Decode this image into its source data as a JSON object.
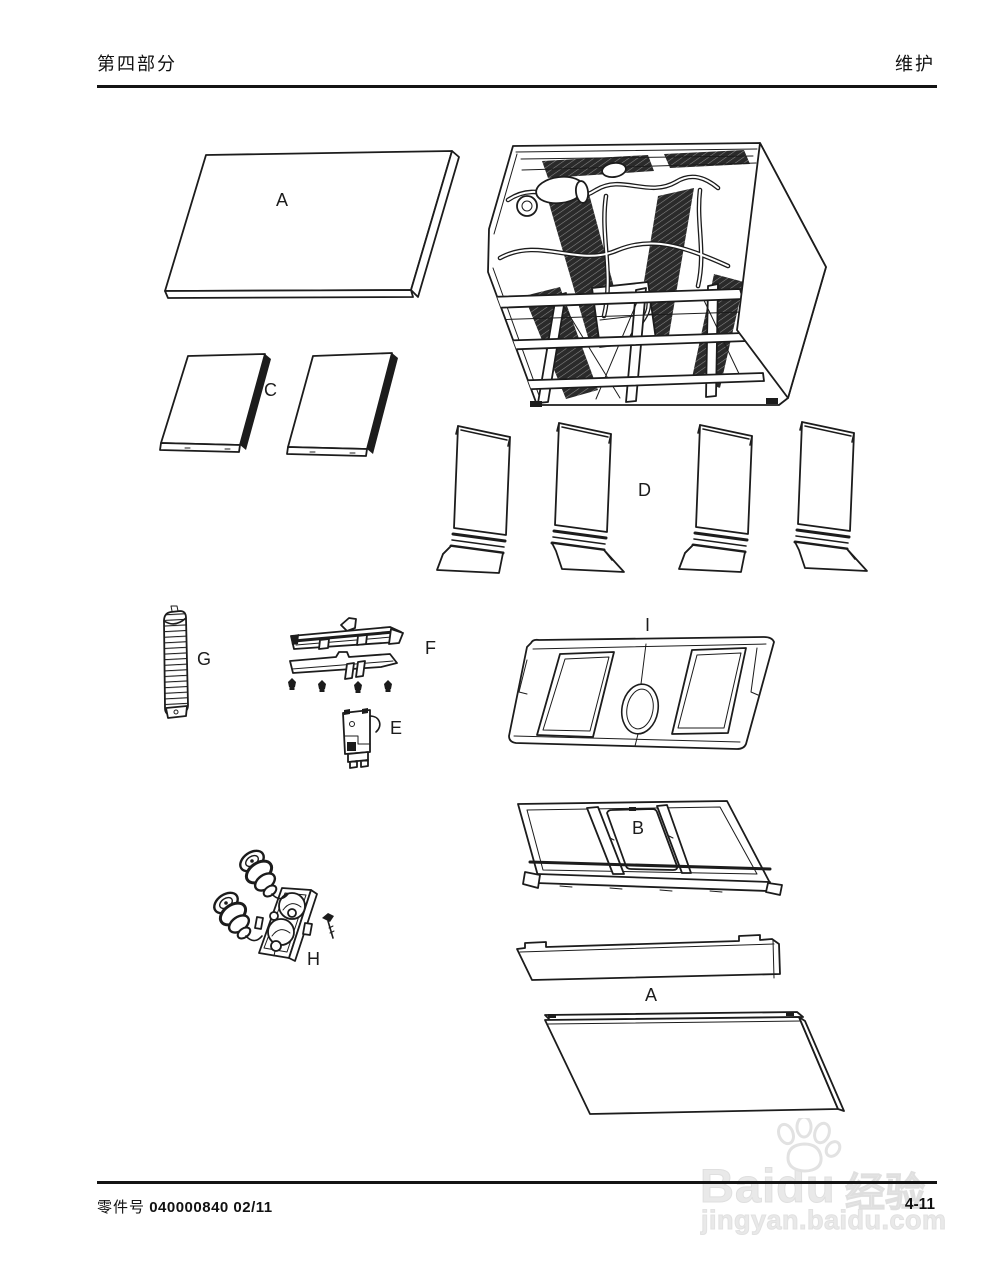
{
  "header": {
    "section": "第四部分",
    "title": "维护"
  },
  "diagram": {
    "labels": {
      "a_top": "A",
      "c": "C",
      "d": "D",
      "g": "G",
      "f": "F",
      "e": "E",
      "i": "I",
      "b": "B",
      "h": "H",
      "a_bottom": "A"
    }
  },
  "footer": {
    "part_no_label": "零件号",
    "part_no_value": "040000840 02/11",
    "page_number": "4-11"
  },
  "watermark": {
    "brand": "Baidu",
    "suffix": "经验",
    "url": "jingyan.baidu.com"
  },
  "colors": {
    "ink": "#1c1c1c",
    "watermark": "#e9e9e9"
  }
}
